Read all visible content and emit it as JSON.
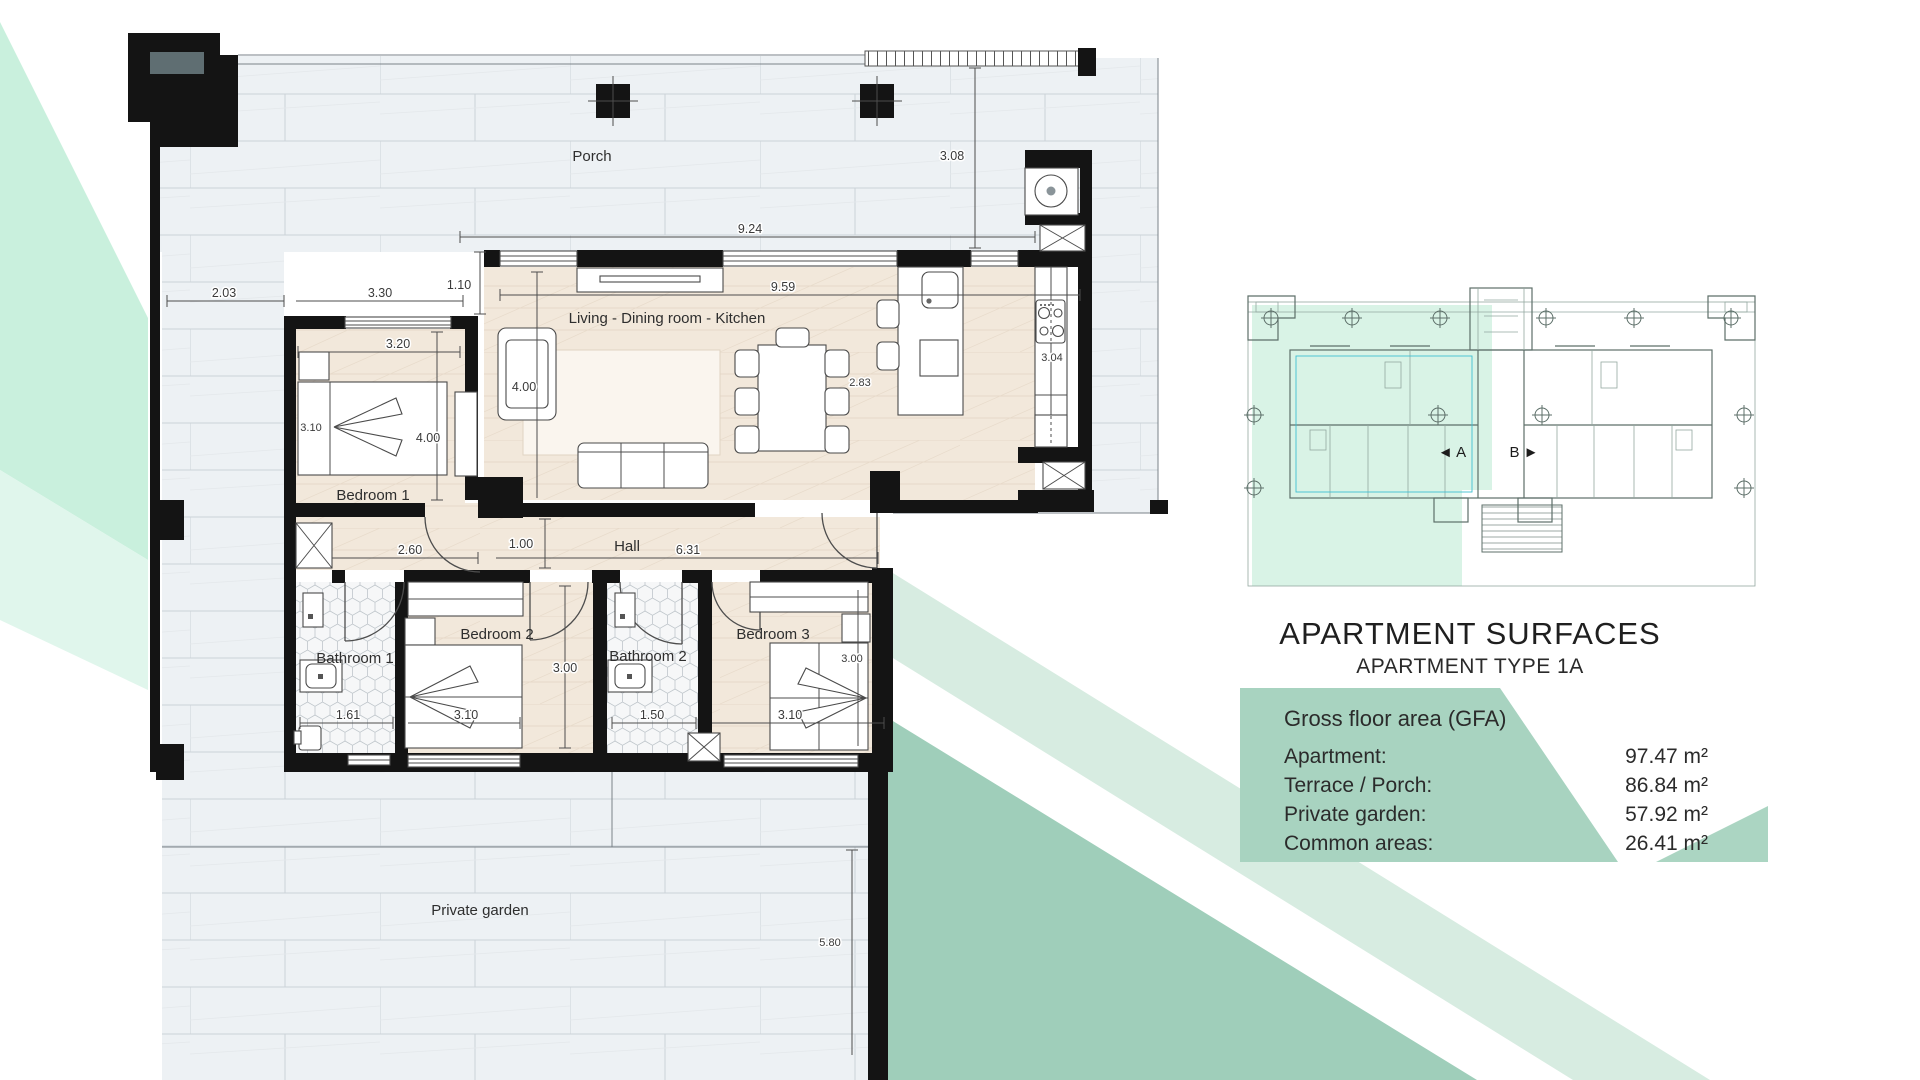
{
  "title_block": {
    "title": "APARTMENT SURFACES",
    "subtitle": "APARTMENT TYPE 1A"
  },
  "gfa_panel": {
    "heading": "Gross floor area (GFA)",
    "rows": [
      {
        "label": "Apartment:",
        "value": "97.47 m²"
      },
      {
        "label": "Terrace / Porch:",
        "value": "86.84 m²"
      },
      {
        "label": "Private garden:",
        "value": "57.92 m²"
      },
      {
        "label": "Common areas:",
        "value": "26.41 m²"
      }
    ]
  },
  "overview": {
    "unit_a": "◄ A",
    "unit_b": "B ►"
  },
  "rooms": {
    "porch": "Porch",
    "living": "Living - Dining room - Kitchen",
    "bedroom1": "Bedroom 1",
    "hall": "Hall",
    "bathroom1": "Bathroom 1",
    "bedroom2": "Bedroom 2",
    "bathroom2": "Bathroom 2",
    "bedroom3": "Bedroom 3",
    "garden": "Private garden"
  },
  "dimensions": {
    "d_924": "9.24",
    "d_308": "3.08",
    "d_203": "2.03",
    "d_330": "3.30",
    "d_110": "1.10",
    "d_959": "9.59",
    "d_320": "3.20",
    "d_400a": "4.00",
    "d_400b": "4.00",
    "d_310a": "3.10",
    "d_260": "2.60",
    "d_100": "1.00",
    "d_631": "6.31",
    "d_300a": "3.00",
    "d_161": "1.61",
    "d_310b": "3.10",
    "d_150": "1.50",
    "d_300b": "3.00",
    "d_310c": "3.10",
    "d_580": "5.80",
    "d_304": "3.04",
    "d_283": "2.83"
  },
  "colors": {
    "mint": "#c9f0dd",
    "mint_light": "#e0f6ec",
    "sage": "#9fceba",
    "sage_pale": "#d7ece1",
    "panel_green": "#a8d3c0",
    "panel_wedge": "#abd5c2",
    "mini_mint": "#d9f3e6"
  }
}
